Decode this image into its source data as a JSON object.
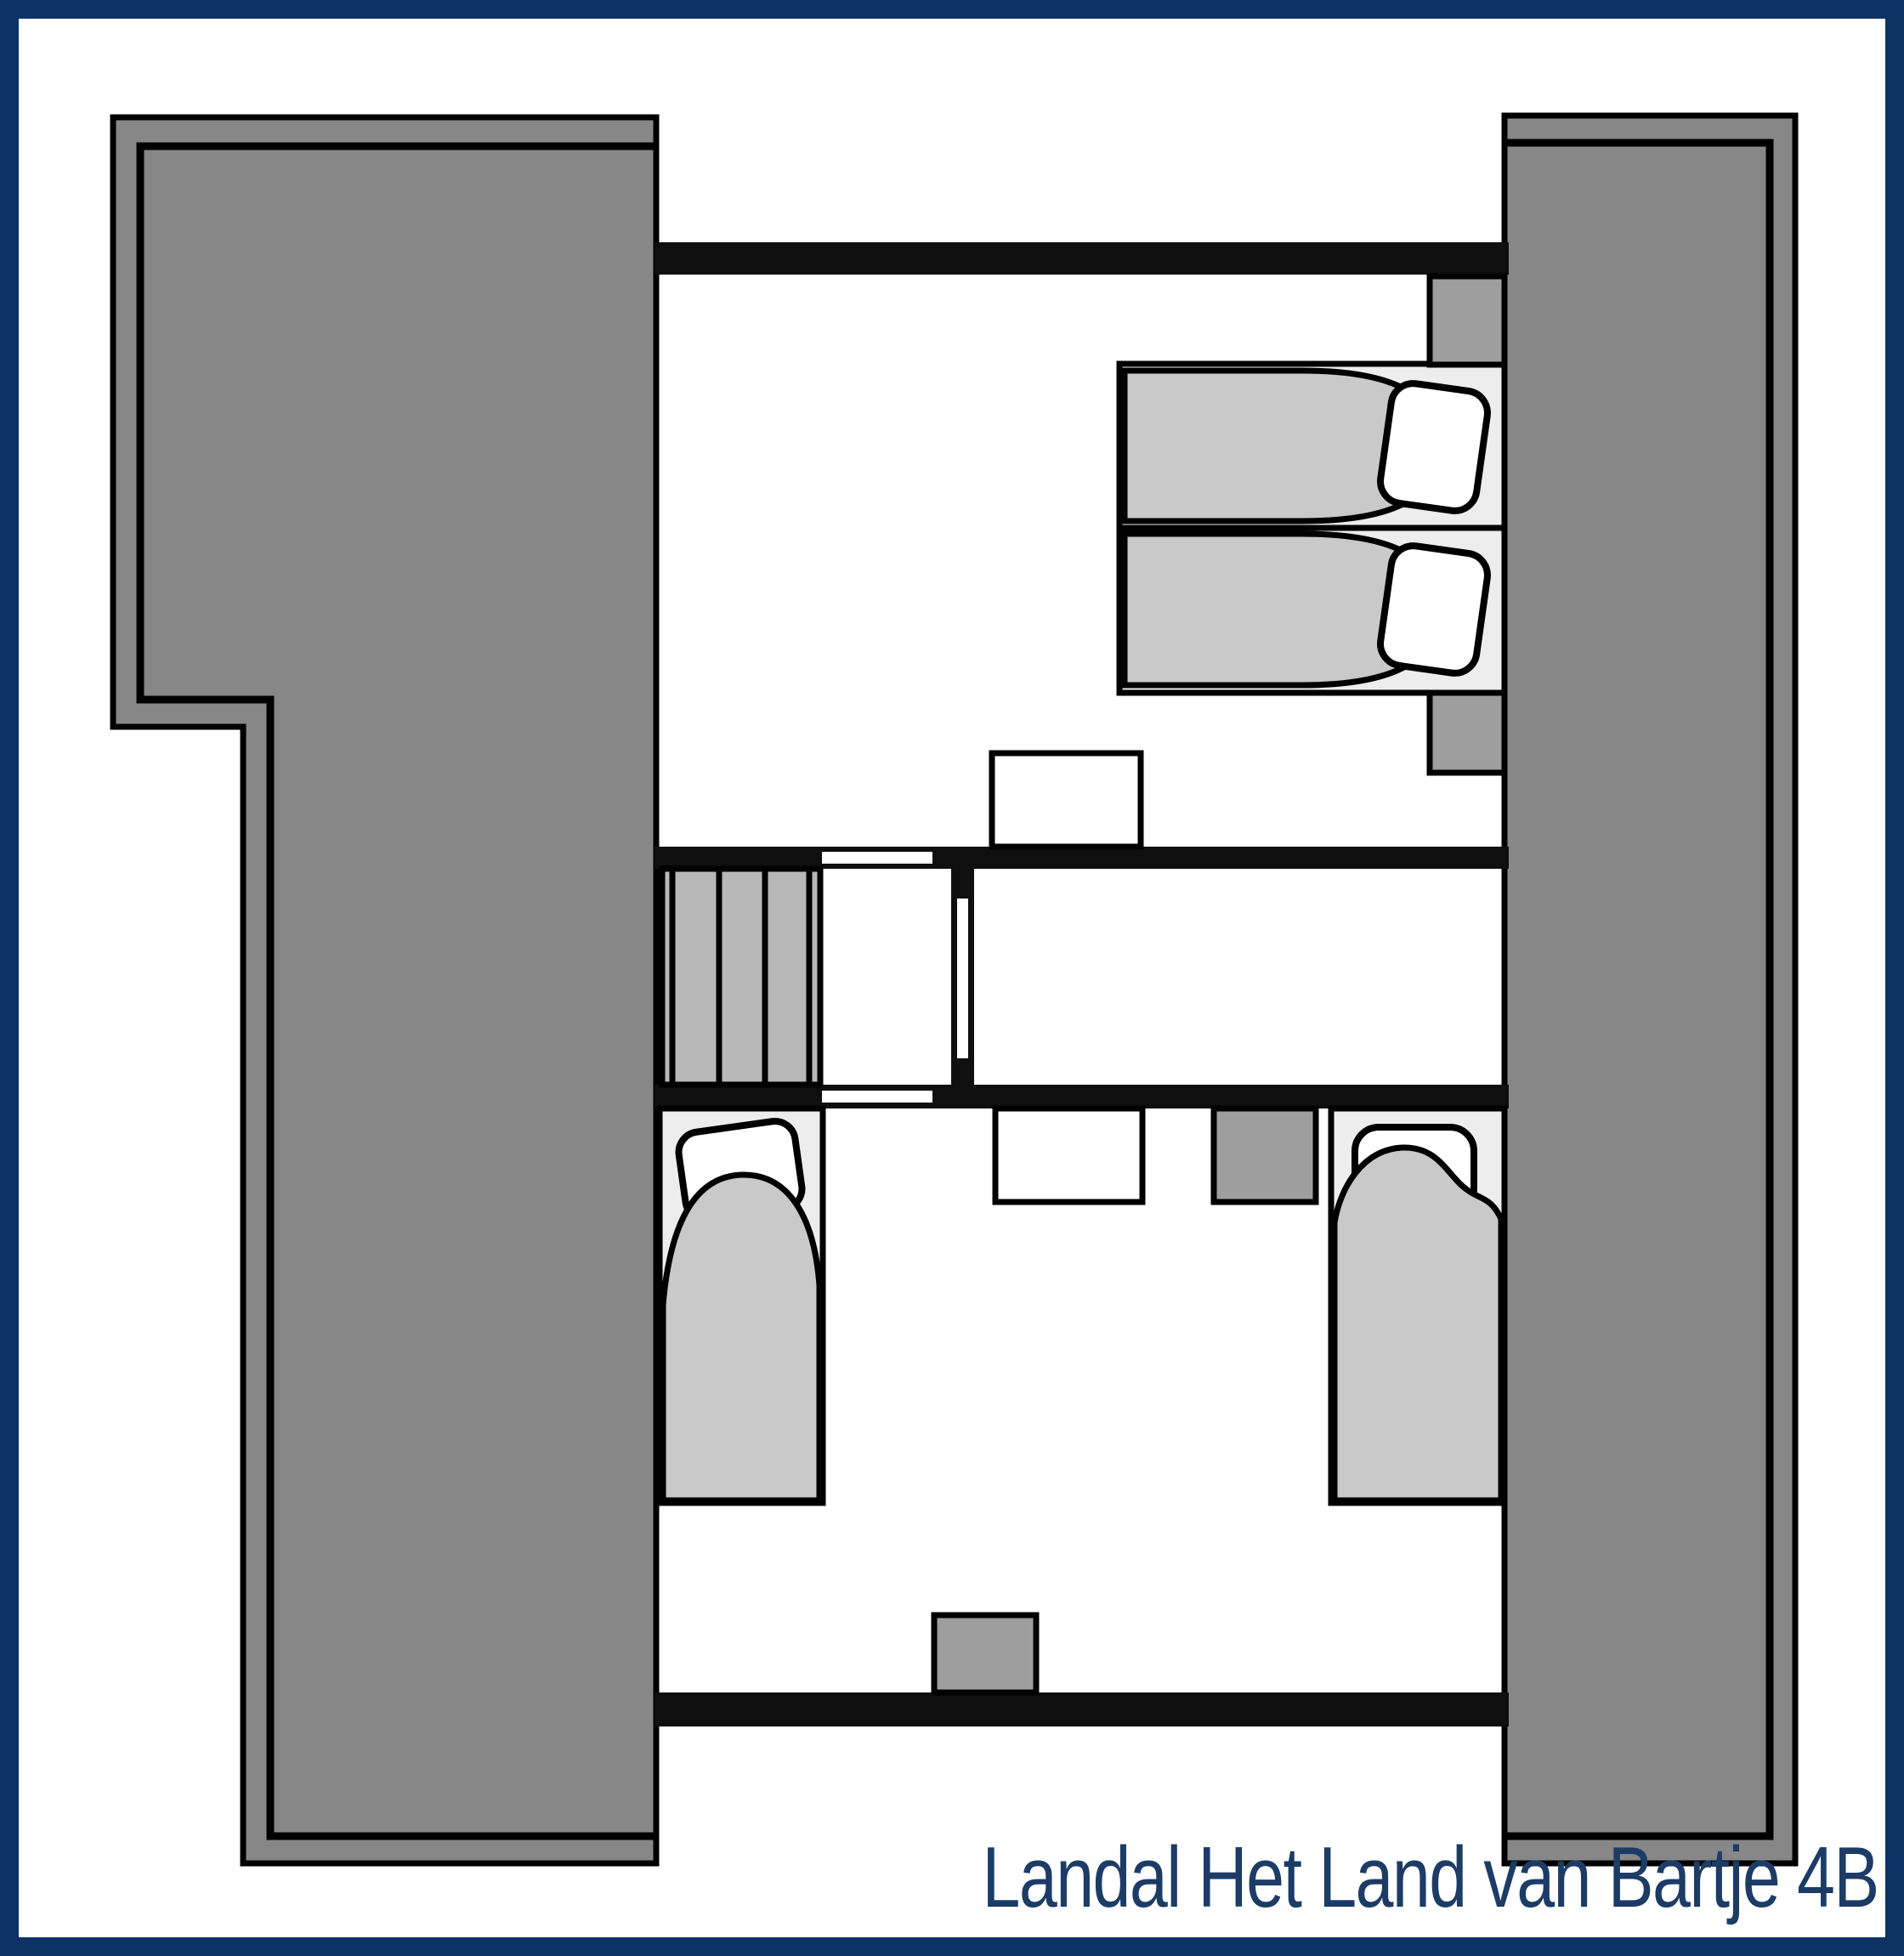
{
  "title": {
    "text": "Landal Het Land van Bartje 4B"
  },
  "colors": {
    "frame_navy": "#0d3264",
    "title_navy": "#1c3c66",
    "background_white": "#ffffff",
    "roof_gray": "#878787",
    "wall_black": "#0f0f0f",
    "door_marker_white": "#ffffff",
    "stair_tread_gray": "#b8b8b8",
    "bed_base_gray": "#ededed",
    "duvet_gray": "#c9c9c9",
    "pillow_white": "#ffffff",
    "furniture_dark_gray": "#9e9e9e"
  },
  "plan": {
    "type": "floor-plan",
    "elements": [
      "left-roof-slope",
      "right-roof-slope",
      "top-bedroom",
      "double-bed",
      "double-bed-pillows",
      "nightstand-top",
      "nightstand-bottom",
      "dresser-top-bedroom",
      "staircase",
      "landing",
      "middle-room",
      "door-opening-top-bedroom",
      "door-opening-bottom-bedroom",
      "door-opening-middle-room",
      "bottom-bedroom",
      "single-bed-left",
      "single-bed-right",
      "dresser-bottom-bedroom",
      "cabinet-bottom-bedroom",
      "cabinet-on-bottom-wall"
    ],
    "stair_tread_count": 5
  }
}
